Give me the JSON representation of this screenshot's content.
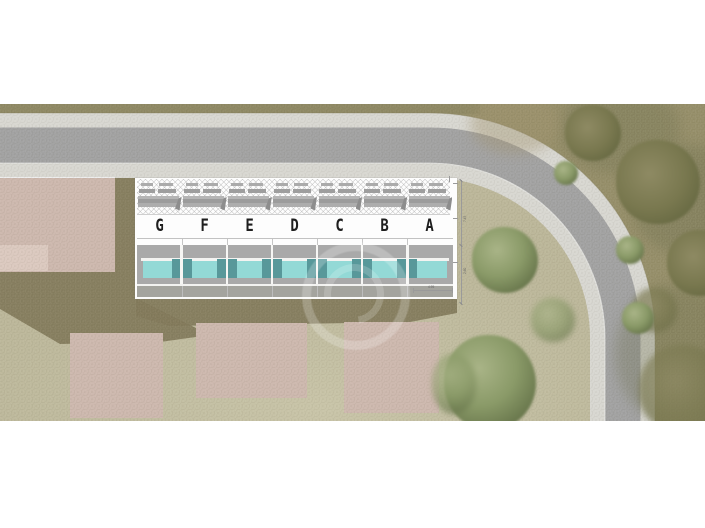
{
  "plan": {
    "units": [
      {
        "label": "G"
      },
      {
        "label": "F"
      },
      {
        "label": "E"
      },
      {
        "label": "D"
      },
      {
        "label": "C"
      },
      {
        "label": "B"
      },
      {
        "label": "A"
      }
    ],
    "dimensions": {
      "terrace_width_label": "4.95",
      "side_depth_label_a": "7.45",
      "side_depth_label_b": "2.60"
    },
    "colors": {
      "pool_water": "#93d9d6",
      "pool_deep": "#58989a",
      "terrace_grey": "#a9a9a9",
      "road_asphalt": "#a2a2a2",
      "sidewalk": "#d8d7d1",
      "grass_inner": "#bcb79a",
      "grass_outer": "#968f6a",
      "building_pink": "#cdb8ae",
      "shadow_olive": "#827a5b",
      "tree_green": "#7e8f5d"
    }
  }
}
